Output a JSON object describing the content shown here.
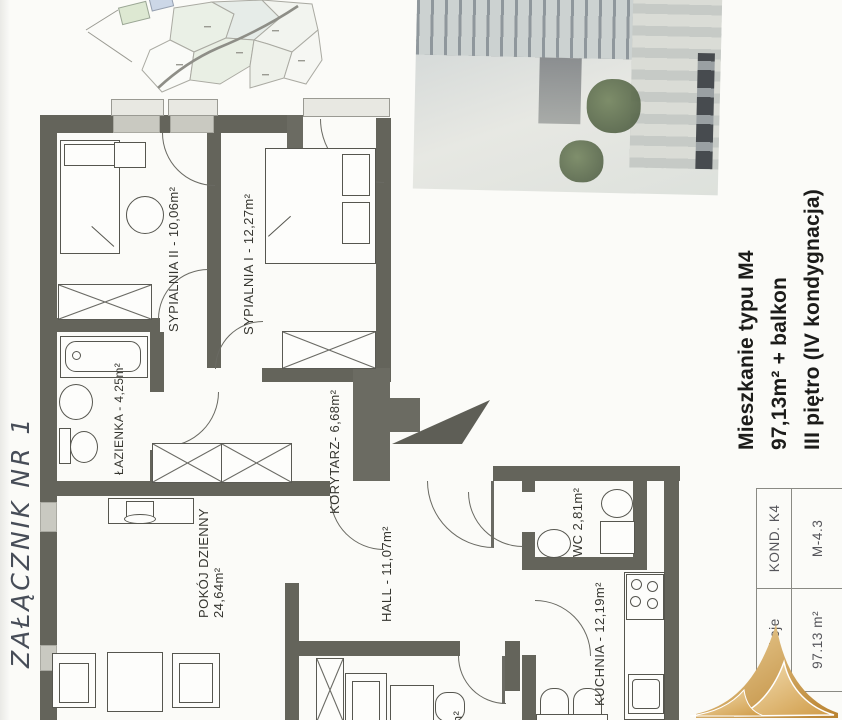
{
  "annotation": {
    "text": "ZAŁĄCZNIK NR 1"
  },
  "plan": {
    "wall_color": "#64645b",
    "rooms": [
      {
        "id": "sypialnia-2",
        "label": "SYPIALNIA II - 10,06m²"
      },
      {
        "id": "sypialnia-1",
        "label": "SYPIALNIA I - 12,27m²"
      },
      {
        "id": "lazienka",
        "label": "ŁAZIENKA - 4,25m²"
      },
      {
        "id": "korytarz",
        "label": "KORYTARZ- 6,68m²"
      },
      {
        "id": "pokoj-dzienny",
        "label": "POKÓJ DZIENNY",
        "area": "24,64m²"
      },
      {
        "id": "hall",
        "label": "HALL - 11,07m²"
      },
      {
        "id": "wc",
        "label": "WC 2,81m²"
      },
      {
        "id": "kuchnia",
        "label": "KUCHNIA - 12,19m²"
      },
      {
        "id": "pokoj-3",
        "label": "16m²"
      }
    ]
  },
  "info": {
    "line1": "Mieszkanie typu M4",
    "line2": "97,13m² + balkon",
    "line3": "III piętro (IV kondygnacja)"
  },
  "table": {
    "rooms_label": "pokoje",
    "area_value": "97.13 m²",
    "floor_label": "KOND. K4",
    "unit_value": "M-4.3"
  },
  "colors": {
    "logo_gold": "#c98f38",
    "wall": "#64645b"
  }
}
